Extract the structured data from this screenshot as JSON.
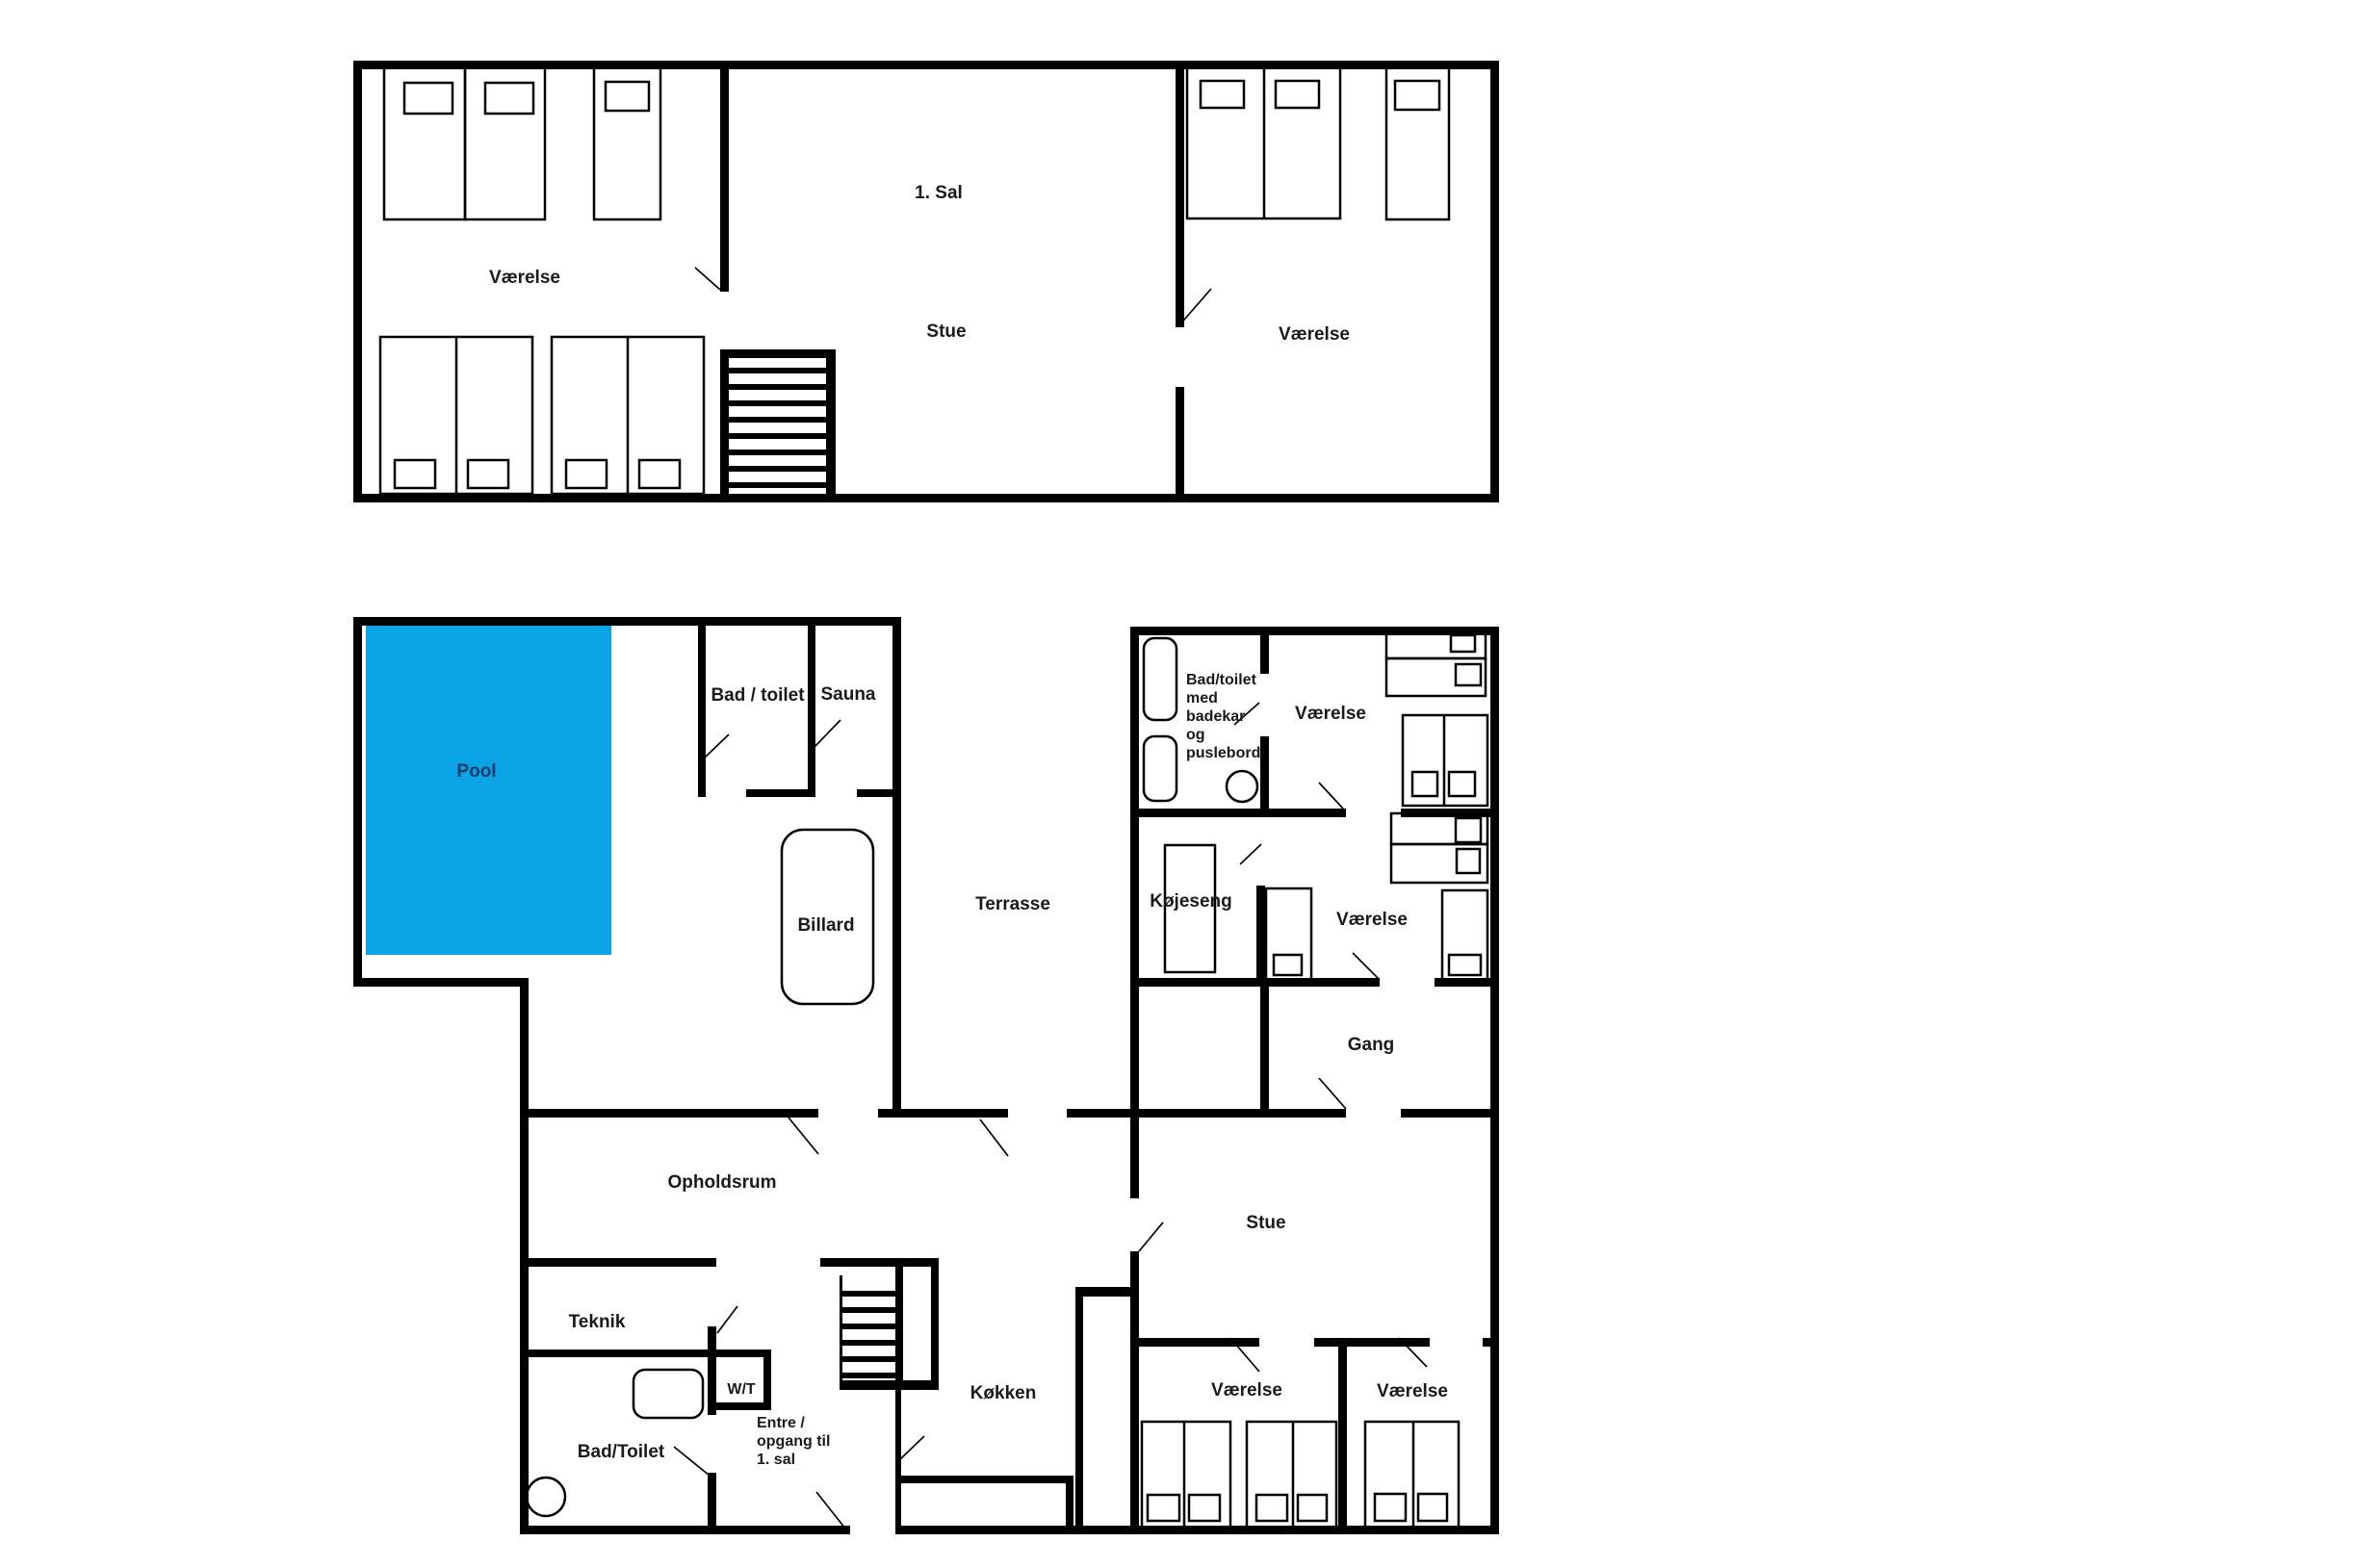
{
  "page": {
    "background": "#ffffff",
    "type": "floor-plan"
  },
  "colors": {
    "wall": "#000000",
    "pool_fill": "#0aa3e4",
    "pool_label": "#1d3c6e",
    "label_text": "#1a1a1a",
    "background": "#ffffff"
  },
  "upper_floor": {
    "labels": {
      "floor": "1. Sal",
      "living": "Stue",
      "bedroom_left": "Værelse",
      "bedroom_right": "Værelse"
    }
  },
  "ground_floor": {
    "labels": {
      "bath": "Bad / toilet",
      "sauna": "Sauna",
      "pool": "Pool",
      "billiard": "Billard",
      "terrace": "Terrasse",
      "family_bath": "Bad/toilet\nmed\nbadekar\nog\npuslebord",
      "bedroom1": "Værelse",
      "bunkroom": "Køjeseng",
      "bedroom2": "Værelse",
      "hall": "Gang",
      "common": "Opholdsrum",
      "tech": "Teknik",
      "wt": "W/T",
      "bath2": "Bad/Toilet",
      "entry": "Entre /\nopgang til\n1. sal",
      "kitchen": "Køkken",
      "living": "Stue",
      "bedroom3": "Værelse",
      "bedroom4": "Værelse"
    }
  }
}
